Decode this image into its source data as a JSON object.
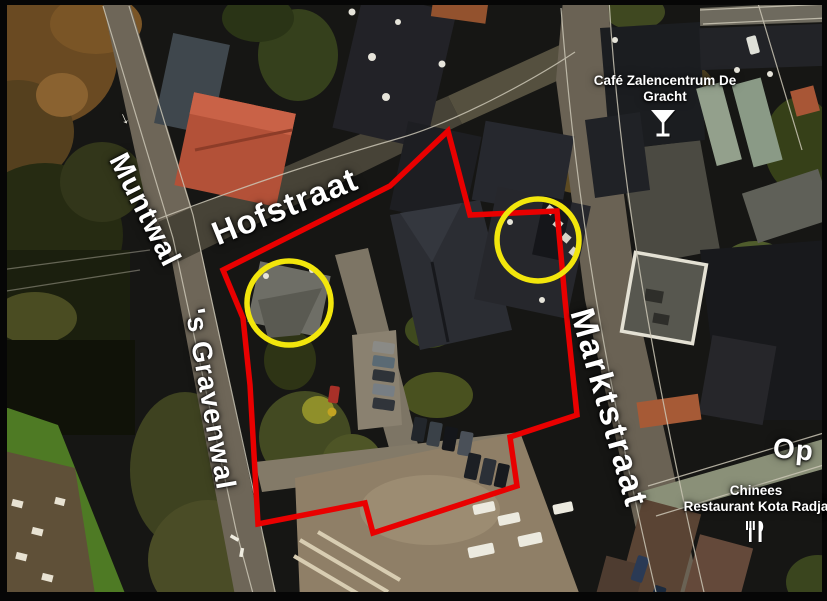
{
  "map": {
    "street_labels": [
      {
        "id": "muntwal",
        "name": "Muntwal"
      },
      {
        "id": "hofstraat",
        "name": "Hofstraat"
      },
      {
        "id": "gravenwal",
        "name": "'s Gravenwal"
      },
      {
        "id": "marktstraat",
        "name": "Marktstraat"
      },
      {
        "id": "op",
        "name": "Op"
      }
    ],
    "pois": [
      {
        "id": "cafe",
        "line1": "Café Zalencentrum De",
        "line2": "Gracht",
        "icon": "cocktail-icon"
      },
      {
        "id": "restaurant",
        "line1": "Chinees",
        "line2": "Restaurant Kota Radja",
        "icon": "restaurant-icon"
      }
    ],
    "one_way_arrow": "→",
    "annotations": {
      "boundary_color": "#e90000",
      "highlight_color": "#f2e60c",
      "highlight_circle_count": 2
    }
  }
}
